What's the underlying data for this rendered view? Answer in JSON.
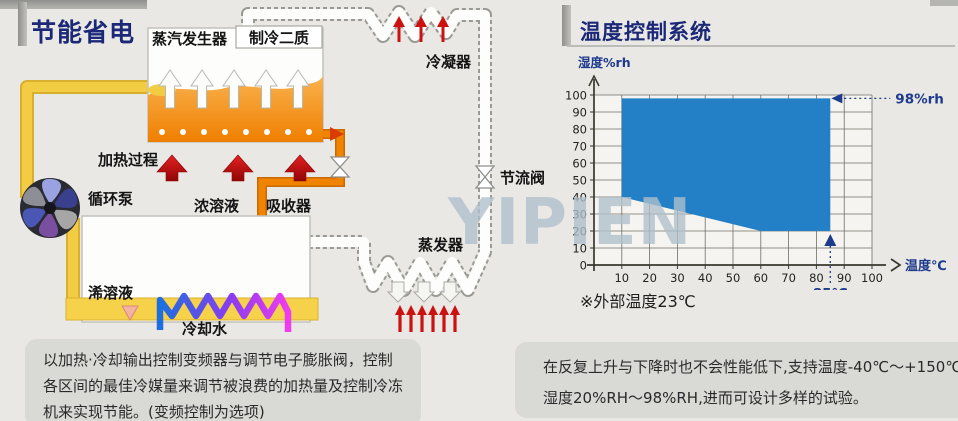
{
  "left_panel": {
    "title": "节能省电",
    "labels": {
      "steam_generator": "蒸汽发生器",
      "refrigerant": "制冷二质",
      "condenser": "冷凝器",
      "heating_process": "加热过程",
      "circulation_pump": "循环泵",
      "concentrated_solution": "浓溶液",
      "absorber": "吸收器",
      "throttle_valve": "节流阀",
      "evaporator": "蒸发器",
      "dilute_solution": "浠溶液",
      "cooling_water": "冷却水"
    },
    "description_lines": [
      "以加热·冷却输出控制变频器与调节电子膨胀阀，控制",
      "各区间的最佳冷媒量来调节被浪费的加热量及控制冷冻",
      "机来实现节能。(变频控制为选项)"
    ]
  },
  "right_panel": {
    "title": "温度控制系统",
    "description_lines": [
      "在反复上升与下降时也不会性能低下,支持温度-40℃～+150℃",
      "湿度20%RH～98%RH,进而可设计多样的试验。"
    ]
  },
  "watermark": "YIPIEN",
  "colors": {
    "title_navy": "#1b2878",
    "chart_blue": "#2380c6",
    "annotation_navy": "#1d3a8c",
    "pipe_yellow": "#f2cd44",
    "tank_orange": "#ef8200",
    "heat_red": "#cc1111"
  },
  "chart_data": {
    "type": "area",
    "title": "",
    "xlabel": "温度℃",
    "ylabel": "湿度%rh",
    "xticks": [
      10,
      20,
      30,
      40,
      50,
      60,
      70,
      80,
      90,
      100
    ],
    "yticks": [
      0,
      10,
      20,
      30,
      40,
      50,
      60,
      70,
      80,
      90,
      100
    ],
    "xlim": [
      0,
      100
    ],
    "ylim": [
      0,
      100
    ],
    "grid": true,
    "region": {
      "name": "controllable-range",
      "color": "#2380c6",
      "points": [
        [
          10,
          40
        ],
        [
          10,
          98
        ],
        [
          85,
          98
        ],
        [
          85,
          20
        ],
        [
          60,
          20
        ]
      ]
    },
    "annotations": [
      {
        "text": "98%rh",
        "x": 85,
        "y": 98,
        "type": "arrow-left"
      },
      {
        "text": "85℃",
        "x": 85,
        "y": 20,
        "type": "arrow-up"
      }
    ],
    "note": "※外部温度23℃"
  }
}
